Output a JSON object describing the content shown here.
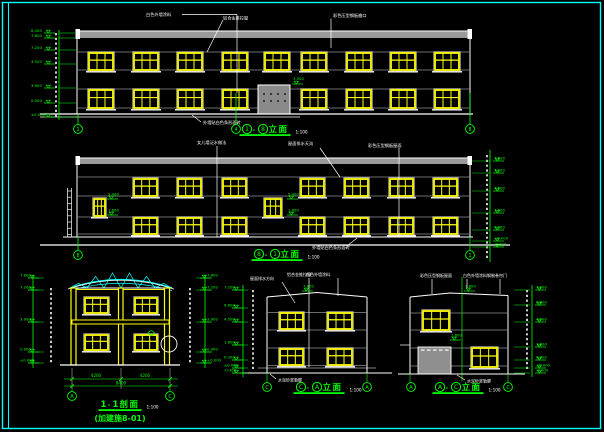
{
  "sheet": {
    "background": "#000000",
    "frame_color": "#00FFFF",
    "line_color": "#FFFFFF",
    "window_color": "#FFFF00",
    "annotation_color": "#00FF00",
    "band_color": "#9A9A9A"
  },
  "views": [
    {
      "name": "front-elevation",
      "title": "①-⑧立面",
      "scale": "1:100",
      "callouts": [
        "白色外墙涂料",
        "铝合金推拉窗",
        "彩色压型钢板檐口"
      ],
      "bottom_note": "外墙贴白色条形面砖",
      "door_level": "3.000",
      "levels_left": [
        "8.400",
        "7.800",
        "7.200",
        "4.500",
        "3.900",
        "0.900",
        "±0.000"
      ],
      "grid_bubbles": [
        "1",
        "4",
        "8"
      ]
    },
    {
      "name": "back-elevation",
      "title": "⑧-①立面",
      "scale": "1:100",
      "callouts": [
        "女儿墙泛水做法",
        "屋面排水天沟",
        "彩色压型钢板屋面"
      ],
      "bottom_note": "外墙贴白色条形面砖",
      "stair_levels": [
        "5.400",
        "1.800"
      ],
      "levels_right": [
        "7.800",
        "7.200",
        "4.500",
        "1.800",
        "0.300",
        "±0.000",
        "-0.300"
      ],
      "grid_bubbles": [
        "8",
        "1"
      ]
    },
    {
      "name": "section-1-1",
      "title": "1-1剖面",
      "scale": "1:100",
      "subtitle": "(加建施8-01)",
      "levels_left": [
        "7.800",
        "7.200",
        "3.900",
        "0.900",
        "±0.000"
      ],
      "levels_right": [
        "7.800",
        "7.200",
        "3.900",
        "0.900",
        "±0.000"
      ],
      "dims": [
        "4200",
        "4200"
      ],
      "total_dim": "8400",
      "grid_bubbles": [
        "A",
        "C"
      ]
    },
    {
      "name": "left-side-elevation",
      "title": "Ⓒ-Ⓐ立面",
      "scale": "1:100",
      "callouts": [
        "屋面排水方向",
        "铝合金推拉窗",
        "白色外墙涂料"
      ],
      "roof_level": "7.800",
      "bottom_note": "水泥砂浆勒脚",
      "levels_left": [
        "7.200",
        "6.600",
        "4.500",
        "1.800",
        "0.300",
        "±0.000",
        "-0.300"
      ],
      "grid_bubbles": [
        "C",
        "A"
      ]
    },
    {
      "name": "right-side-elevation",
      "title": "Ⓐ-Ⓒ立面",
      "scale": "1:100",
      "callouts": [
        "彩色压型钢板屋面",
        "白色外墙涂料",
        "钢制卷帘门"
      ],
      "roof_level": "7.800",
      "mid_level": "1.800",
      "bottom_note": "水泥砂浆勒脚",
      "levels_right": [
        "7.200",
        "6.600",
        "4.500",
        "1.800",
        "0.300",
        "±0.000",
        "-0.300"
      ],
      "grid_bubbles": [
        "A",
        "C"
      ]
    }
  ]
}
